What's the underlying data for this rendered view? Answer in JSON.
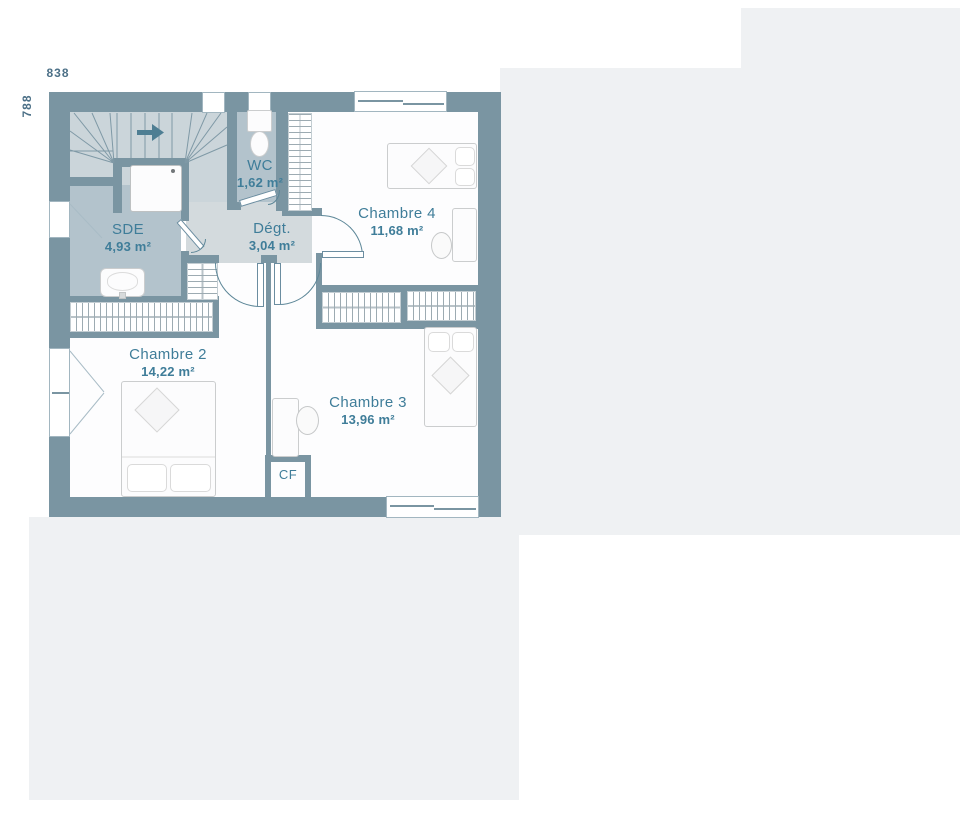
{
  "plan": {
    "title": "floor-plan-upper-storey",
    "dimensions": {
      "width": "838",
      "height": "788"
    },
    "rooms": {
      "sde": {
        "name": "SDE",
        "area": "4,93 m²"
      },
      "wc": {
        "name": "WC",
        "area": "1,62 m²"
      },
      "degt": {
        "name": "Dégt.",
        "area": "3,04 m²"
      },
      "chambre2": {
        "name": "Chambre 2",
        "area": "14,22 m²"
      },
      "chambre3": {
        "name": "Chambre 3",
        "area": "13,96 m²"
      },
      "chambre4": {
        "name": "Chambre 4",
        "area": "11,68 m²"
      }
    },
    "closet_label": "CF",
    "colors": {
      "wall": "#7a95a2",
      "floor_wet_rooms": "#b3c3cc",
      "floor_stairs": "#cbd5da",
      "floor_hall": "#d3dadd",
      "floor_bedrooms": "#fdfdfe",
      "label_text": "#3f7d99",
      "dimension_text": "#4c7087",
      "background_panels": "#eff1f3"
    }
  }
}
